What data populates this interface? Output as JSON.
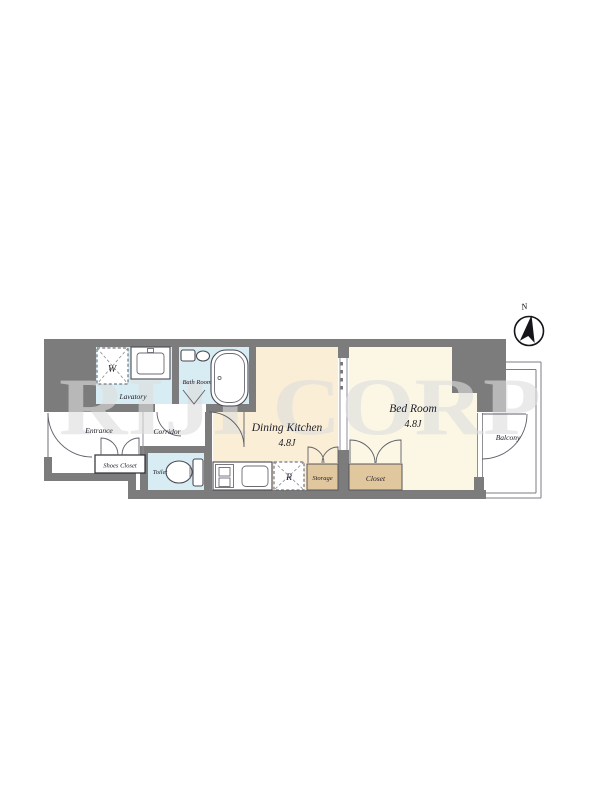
{
  "floorplan": {
    "watermark": "RIJI CORP",
    "compass": {
      "north_label": "N"
    },
    "rooms": {
      "lavatory": "Lavatory",
      "bath_room": "Bath Room",
      "entrance": "Entrance",
      "corridor": "Corridor",
      "shoes_closet": "Shoes Closet",
      "toilet": "Toilet",
      "dining_kitchen": "Dining Kitchen",
      "dining_kitchen_size": "4.8J",
      "bed_room": "Bed Room",
      "bed_room_size": "4.8J",
      "storage": "Storage",
      "closet": "Closet",
      "balcony": "Balcony"
    },
    "fixtures": {
      "washer_symbol": "W",
      "refrigerator_symbol": "R"
    },
    "colors": {
      "wall": "#7c7c7c",
      "dk": "#fbeed6",
      "bed": "#fbf7e4",
      "wet": "#d8edf3",
      "tan": "#e1c79e"
    }
  }
}
